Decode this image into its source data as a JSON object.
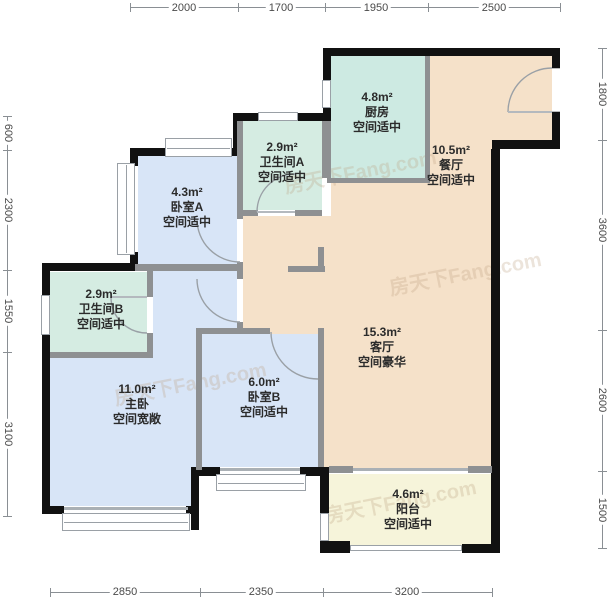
{
  "watermark": "房天下Fang.com",
  "rooms": [
    {
      "id": "kitchen",
      "area": "4.8m²",
      "name": "厨房",
      "desc": "空间适中",
      "color": "#cdeae2"
    },
    {
      "id": "dining",
      "area": "10.5m²",
      "name": "餐厅",
      "desc": "空间适中",
      "color": "#f5e1c9"
    },
    {
      "id": "bath-a",
      "area": "2.9m²",
      "name": "卫生间A",
      "desc": "空间适中",
      "color": "#d5ece2"
    },
    {
      "id": "bedroom-a",
      "area": "4.3m²",
      "name": "卧室A",
      "desc": "空间适中",
      "color": "#d8e5f7"
    },
    {
      "id": "bath-b",
      "area": "2.9m²",
      "name": "卫生间B",
      "desc": "空间适中",
      "color": "#d5ece2"
    },
    {
      "id": "master",
      "area": "11.0m²",
      "name": "主卧",
      "desc": "空间宽敞",
      "color": "#d8e5f7"
    },
    {
      "id": "bedroom-b",
      "area": "6.0m²",
      "name": "卧室B",
      "desc": "空间适中",
      "color": "#d8e5f7"
    },
    {
      "id": "living",
      "area": "15.3m²",
      "name": "客厅",
      "desc": "空间豪华",
      "color": "#f5e1c9"
    },
    {
      "id": "balcony",
      "area": "4.6m²",
      "name": "阳台",
      "desc": "空间适中",
      "color": "#f6f4da"
    }
  ],
  "dims": {
    "top": [
      "2000",
      "1700",
      "1950",
      "2500"
    ],
    "bottom": [
      "2850",
      "2350",
      "3200"
    ],
    "left": [
      "600",
      "2300",
      "1550",
      "3100"
    ],
    "right": [
      "1800",
      "3600",
      "2600",
      "1500"
    ]
  },
  "colors": {
    "exterior_wall": "#111111",
    "interior_wall": "#8e9092",
    "window_line": "#9aa0a6",
    "dim_text": "#4a4a4a",
    "room_text": "#2b2b2b",
    "bedroom_fill": "#d8e5f7",
    "bath_fill": "#d5ece2",
    "kitchen_fill": "#cdeae2",
    "living_fill": "#f5e1c9",
    "balcony_fill": "#f6f4da"
  }
}
